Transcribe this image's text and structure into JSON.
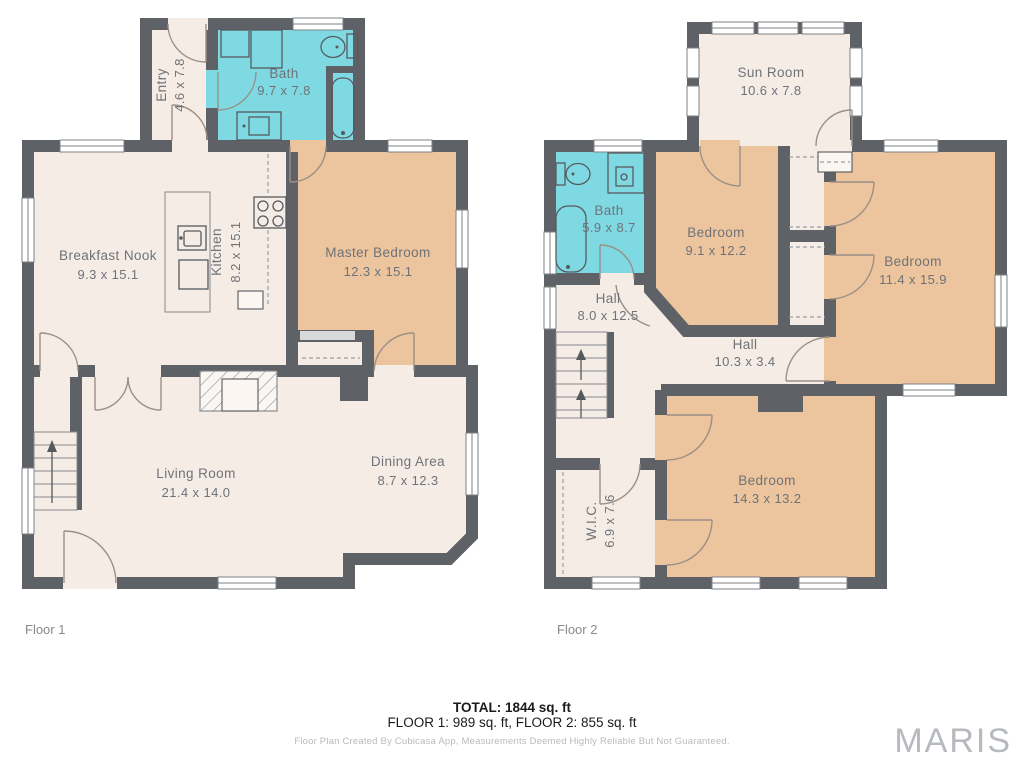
{
  "floor1": {
    "label": "Floor 1",
    "rooms": {
      "entry": {
        "name": "Entry",
        "dims": "4.6 x 7.8"
      },
      "bath": {
        "name": "Bath",
        "dims": "9.7 x 7.8"
      },
      "breakfast_nook": {
        "name": "Breakfast Nook",
        "dims": "9.3 x 15.1"
      },
      "kitchen": {
        "name": "Kitchen",
        "dims": "8.2 x 15.1"
      },
      "master_bedroom": {
        "name": "Master Bedroom",
        "dims": "12.3 x 15.1"
      },
      "living_room": {
        "name": "Living Room",
        "dims": "21.4 x 14.0"
      },
      "dining_area": {
        "name": "Dining Area",
        "dims": "8.7 x 12.3"
      }
    }
  },
  "floor2": {
    "label": "Floor 2",
    "rooms": {
      "sun_room": {
        "name": "Sun Room",
        "dims": "10.6 x 7.8"
      },
      "bath": {
        "name": "Bath",
        "dims": "5.9 x 8.7"
      },
      "bedroom_a": {
        "name": "Bedroom",
        "dims": "9.1 x 12.2"
      },
      "bedroom_b": {
        "name": "Bedroom",
        "dims": "11.4 x 15.9"
      },
      "hall_upper": {
        "name": "Hall",
        "dims": "8.0 x 12.5"
      },
      "hall_corridor": {
        "name": "Hall",
        "dims": "10.3 x 3.4"
      },
      "bedroom_c": {
        "name": "Bedroom",
        "dims": "14.3 x 13.2"
      },
      "wic": {
        "name": "W.I.C.",
        "dims": "6.9 x 7.6"
      }
    }
  },
  "footer": {
    "total": "TOTAL: 1844 sq. ft",
    "floors": "FLOOR 1: 989 sq. ft, FLOOR 2: 855 sq. ft",
    "disclaimer": "Floor Plan Created By Cubicasa App, Measurements Deemed Highly Reliable But Not Guaranteed."
  },
  "watermark": "MARIS",
  "colors": {
    "wall": "#5e6166",
    "room_cream": "#f5ece6",
    "bedroom_tan": "#ecc49d",
    "bath_cyan": "#7fd9e2",
    "label_gray": "#6f7378",
    "watermark_gray": "#b6b9bd"
  }
}
